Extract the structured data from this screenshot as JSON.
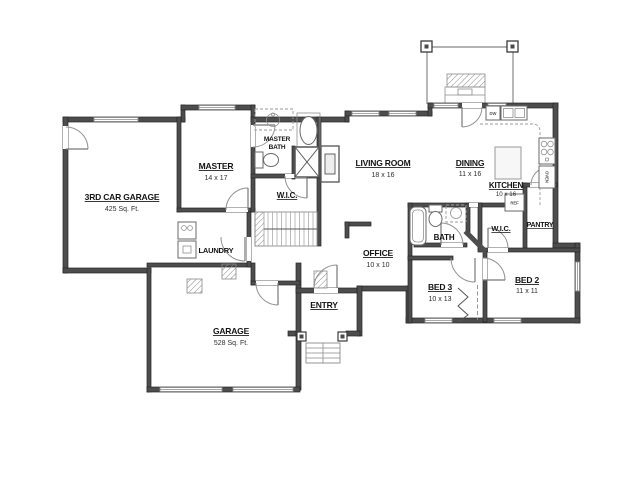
{
  "plan": {
    "colors": {
      "wall": "#4d4d4d",
      "background": "#ffffff",
      "thin_line": "#9a9a9a"
    },
    "rooms": {
      "third_car_garage": {
        "label": "3RD CAR GARAGE",
        "dims": "425 Sq. Ft."
      },
      "master": {
        "label": "MASTER",
        "dims": "14 x 17"
      },
      "master_bath": {
        "line1": "MASTER",
        "line2": "BATH"
      },
      "wic_master": {
        "label": "W.I.C."
      },
      "laundry": {
        "label": "LAUNDRY"
      },
      "living_room": {
        "label": "LIVING ROOM",
        "dims": "18 x 16"
      },
      "dining": {
        "label": "DINING",
        "dims": "11 x 16"
      },
      "kitchen": {
        "label": "KITCHEN",
        "dims": "10 x 16"
      },
      "pantry": {
        "label": "PANTRY"
      },
      "wic_bed2": {
        "label": "W.I.C."
      },
      "bath": {
        "label": "BATH"
      },
      "office": {
        "label": "OFFICE",
        "dims": "10 x 10"
      },
      "bed3": {
        "label": "BED 3",
        "dims": "10 x 13"
      },
      "bed2": {
        "label": "BED 2",
        "dims": "11 x 11"
      },
      "entry": {
        "label": "ENTRY"
      },
      "garage": {
        "label": "GARAGE",
        "dims": "528 Sq. Ft."
      }
    },
    "appliances": {
      "dw": "DW",
      "ref": "REF",
      "oven": "OVEN"
    }
  }
}
